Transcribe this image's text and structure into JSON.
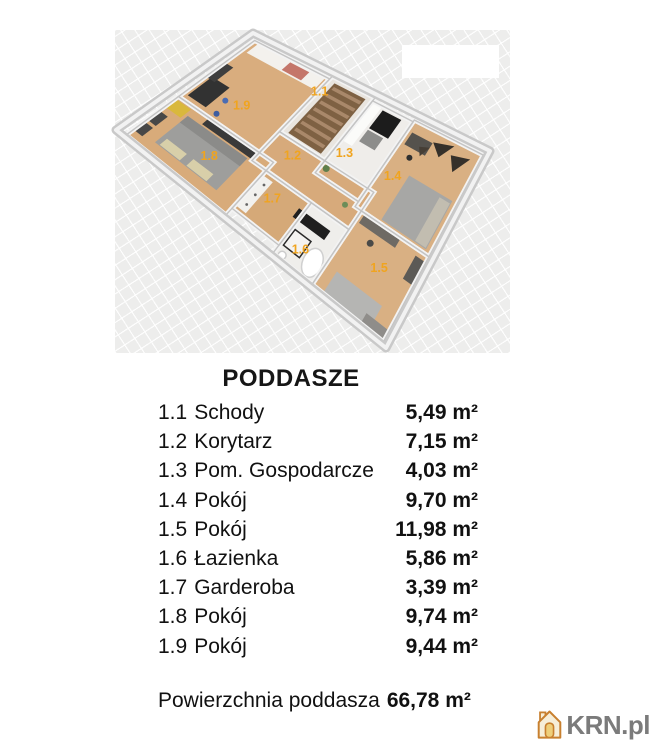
{
  "title": "PODDASZE",
  "plan": {
    "label_color": "#f0a41f"
  },
  "legend": {
    "rows": [
      {
        "no": "1.1",
        "name": "Schody",
        "area": "5,49 m²"
      },
      {
        "no": "1.2",
        "name": "Korytarz",
        "area": "7,15 m²"
      },
      {
        "no": "1.3",
        "name": "Pom. Gospodarcze",
        "area": "4,03 m²"
      },
      {
        "no": "1.4",
        "name": "Pokój",
        "area": "9,70 m²"
      },
      {
        "no": "1.5",
        "name": "Pokój",
        "area": "11,98 m²"
      },
      {
        "no": "1.6",
        "name": "Łazienka",
        "area": "5,86 m²"
      },
      {
        "no": "1.7",
        "name": "Garderoba",
        "area": "3,39 m²"
      },
      {
        "no": "1.8",
        "name": "Pokój",
        "area": "9,74 m²"
      },
      {
        "no": "1.9",
        "name": "Pokój",
        "area": "9,44 m²"
      }
    ],
    "summary_label": "Powierzchnia poddasza",
    "summary_value": "66,78 m²"
  },
  "watermark": {
    "text": "KRN.pl",
    "icon": "house-icon",
    "icon_color": "#c8802f",
    "icon_fill": "#f6eed8",
    "door_color": "#eecf7a",
    "text_color": "#7b7b7b"
  }
}
